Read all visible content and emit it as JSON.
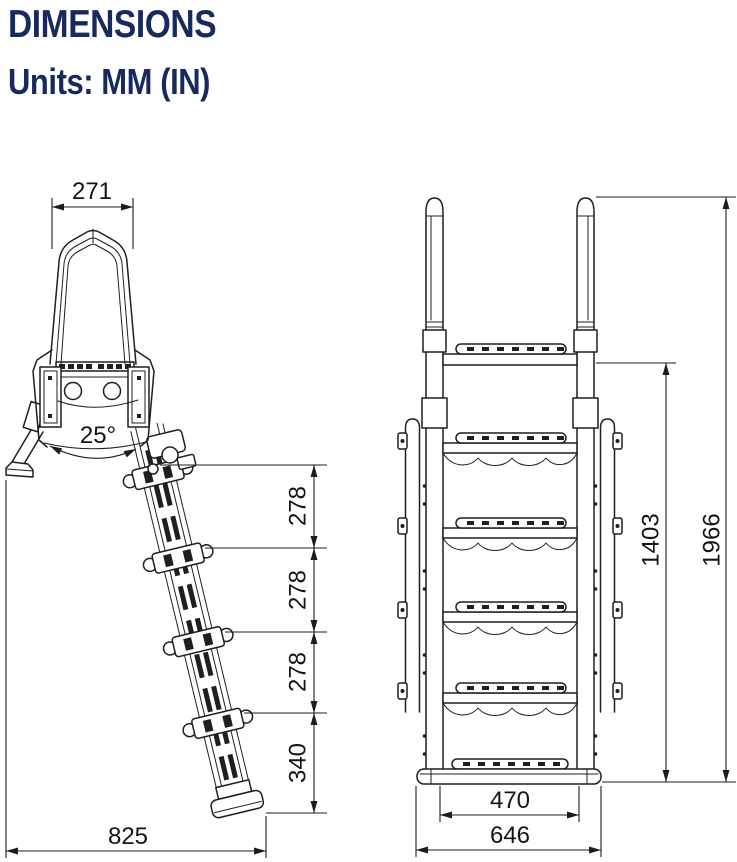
{
  "colors": {
    "title": "#172a5e",
    "line": "#1f1f1f",
    "dim": "#1c1c1c"
  },
  "header": {
    "title": "DIMENSIONS",
    "units": "Units: MM (IN)"
  },
  "side_view": {
    "dims": {
      "handle_top_width": "271",
      "leg_angle": "25°",
      "step_spacing_upper": "278",
      "step_spacing_middle": "278",
      "step_spacing_lower": "278",
      "bottom_section_height": "340",
      "base_depth": "825"
    }
  },
  "front_view": {
    "dims": {
      "platform_height": "1403",
      "total_height": "1966",
      "base_inner_width": "470",
      "base_outer_width": "646"
    }
  }
}
